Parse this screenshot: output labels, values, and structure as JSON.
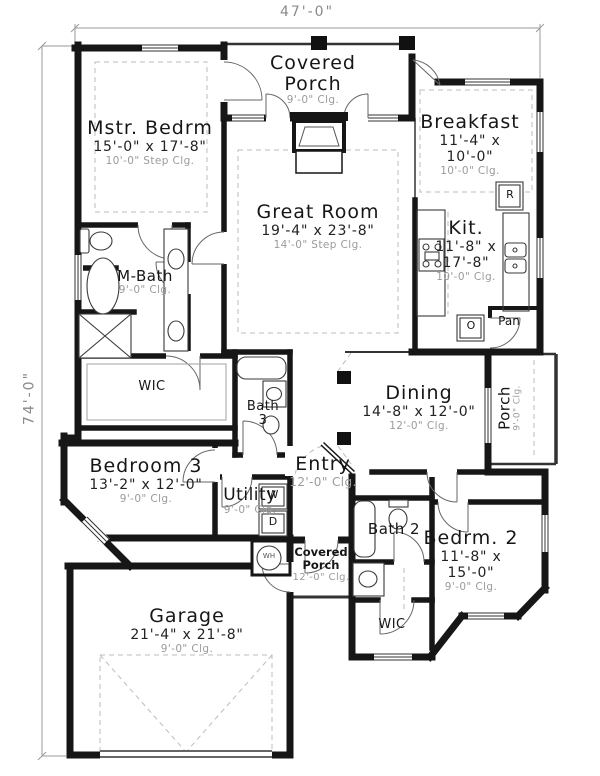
{
  "colors": {
    "wall": "#161616",
    "ceiling_text": "#9b9b9b",
    "dimension_text": "#8a8a8a"
  },
  "dimensions": {
    "overall_width": "47'-0\"",
    "overall_depth": "74'-0\""
  },
  "rooms": {
    "covered_porch_top": {
      "line1": "Covered",
      "line2": "Porch",
      "clg": "9'-0\" Clg."
    },
    "mstr_bedrm": {
      "name": "Mstr. Bedrm",
      "size": "15'-0\" x 17'-8\"",
      "clg": "10'-0\" Step Clg."
    },
    "breakfast": {
      "name": "Breakfast",
      "size1": "11'-4\" x",
      "size2": "10'-0\"",
      "clg": "10'-0\" Clg."
    },
    "great_room": {
      "name": "Great Room",
      "size": "19'-4\" x 23'-8\"",
      "clg": "14'-0\" Step Clg."
    },
    "kitchen": {
      "name": "Kit.",
      "size1": "11'-8\" x",
      "size2": "17'-8\"",
      "clg": "10'-0\" Clg."
    },
    "m_bath": {
      "name": "M-Bath",
      "clg": "9'-0\" Clg."
    },
    "wic_master": {
      "name": "WIC"
    },
    "bath3": {
      "line1": "Bath",
      "line2": "3"
    },
    "dining": {
      "name": "Dining",
      "size": "14'-8\" x 12'-0\"",
      "clg": "12'-0\" Clg."
    },
    "porch_right": {
      "name": "Porch",
      "clg": "9'-0\" Clg."
    },
    "bedroom3": {
      "name": "Bedroom 3",
      "size": "13'-2\" x 12'-0\"",
      "clg": "9'-0\" Clg."
    },
    "entry": {
      "name": "Entry",
      "clg": "12'-0\" Clg."
    },
    "utility": {
      "name": "Utility",
      "clg": "9'-0\" Clg."
    },
    "covered_porch_bottom": {
      "line1": "Covered",
      "line2": "Porch",
      "clg": "12'-0\" Clg."
    },
    "bath2": {
      "name": "Bath 2"
    },
    "bedrm2": {
      "name": "Bedrm. 2",
      "size1": "11'-8\" x",
      "size2": "15'-0\"",
      "clg": "9'-0\" Clg."
    },
    "garage": {
      "name": "Garage",
      "size": "21'-4\" x 21'-8\"",
      "clg": "9'-0\" Clg."
    },
    "wic_bedrm2": {
      "name": "WIC"
    },
    "pantry": {
      "name": "Pan"
    }
  },
  "appliances": {
    "refrigerator": "R",
    "oven": "O",
    "washer": "W",
    "dryer": "D",
    "water_heater": "WH"
  }
}
